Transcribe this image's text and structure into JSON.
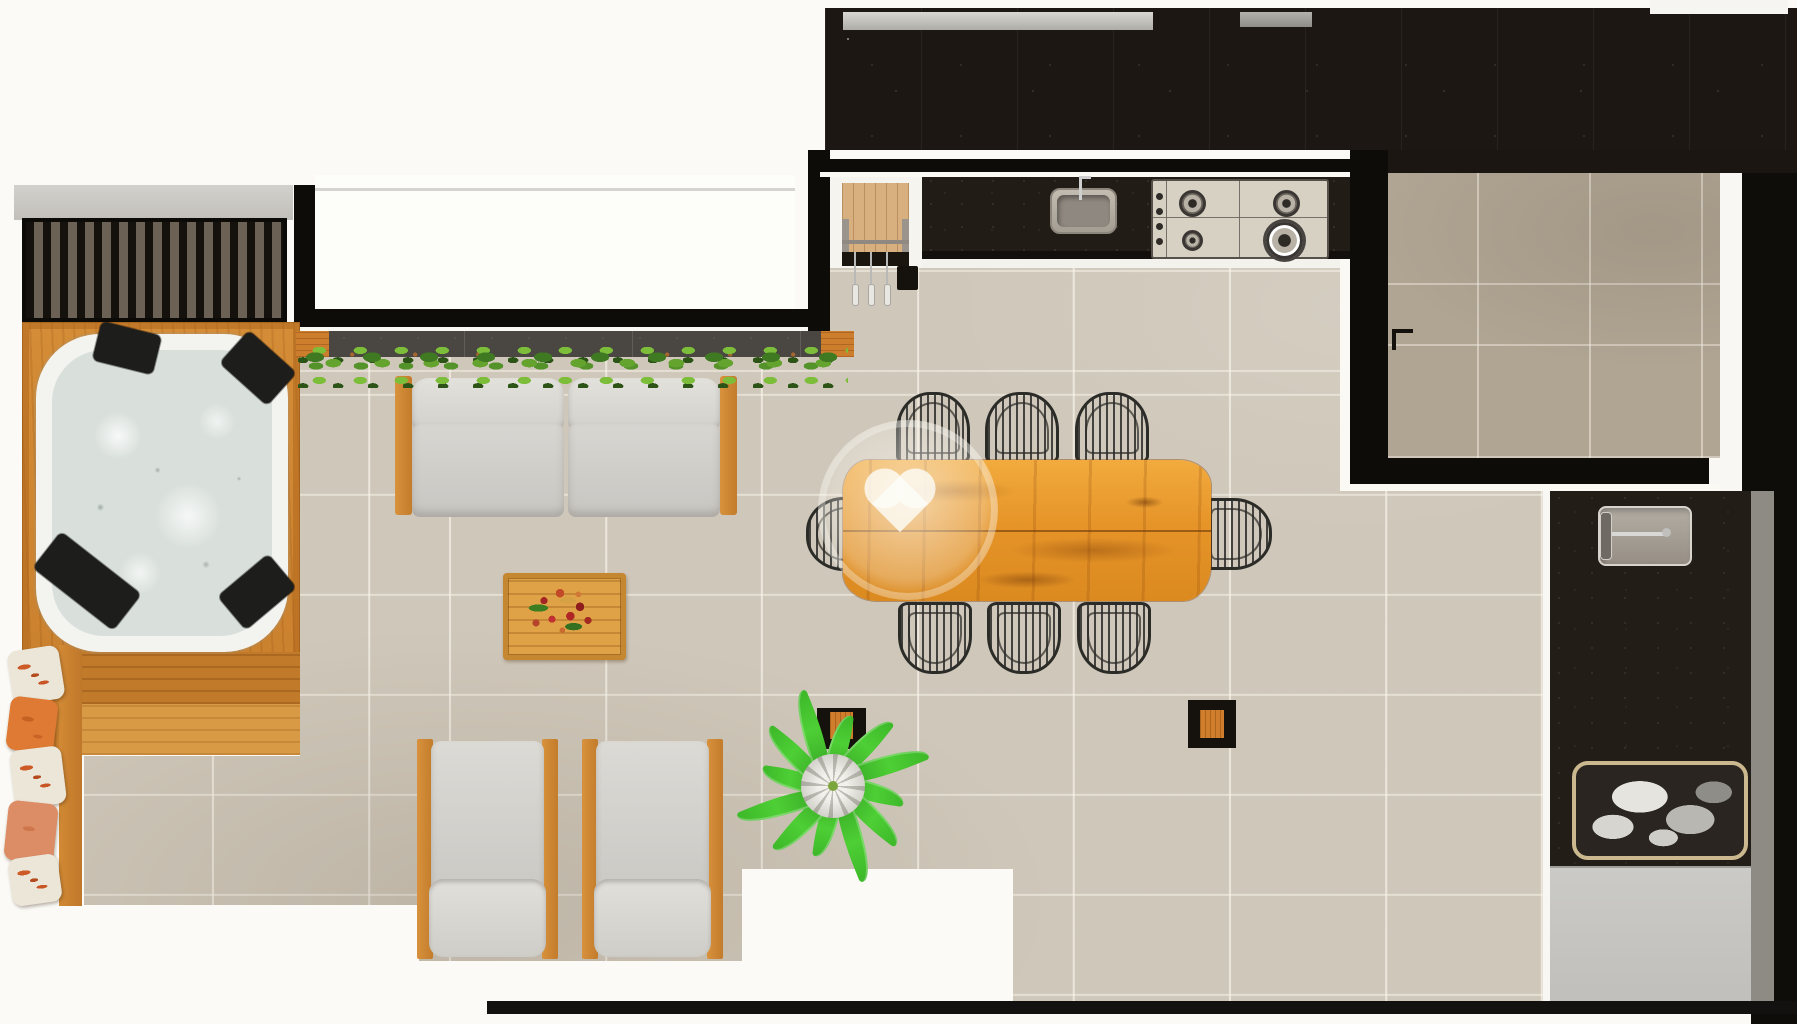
{
  "scene": {
    "kind": "architectural-floor-plan-render",
    "view": "top-down",
    "canvas": {
      "width_px": 1797,
      "height_px": 1024
    },
    "visible_text": "none",
    "watermark": {
      "shape": "heart-in-circle",
      "color": "rgba(250,248,243,0.6)",
      "area": "over dining table left edge"
    }
  },
  "palette": {
    "background_white": "#fbfaf6",
    "terrace_floor": "#cfc7b9",
    "service_room_floor": "#b0a493",
    "roof_mass_black": "#1c1712",
    "wall_black": "#0e0c09",
    "counter_granite": "#211c16",
    "teak_wood": "#d48c36",
    "dining_table_wood": "#e69428",
    "coffee_table_wood": "#e0a246",
    "cabinet_wood": "#d8af7e",
    "cushion_gray": "#d6d4cf",
    "water": "#d9e0dc",
    "hedge_green": "#63a32e",
    "plant_green": "#4ecf35",
    "pillow_orange": "#de7a33",
    "wicker_black": "#2b2b28",
    "gray_mat": "#c6c5c1",
    "stainless": "#d7d1c3"
  },
  "areas": {
    "spa_corner": {
      "label": "Spa deck with hot tub",
      "hot_tub": {
        "headrest_pads": 4,
        "water_state": "bubbling foam"
      },
      "slat_screen": {
        "style": "black louvered slats"
      },
      "lounge_pillows": {
        "count": 5,
        "styles": [
          "white floral",
          "orange",
          "white floral",
          "salmon",
          "white floral"
        ]
      }
    },
    "living_zone": {
      "label": "Outdoor living zone",
      "sofa": {
        "seats": 2,
        "frame": "teak",
        "cushions": "light gray"
      },
      "hedge_planter": {
        "type": "boxwood hedge in dark planter",
        "wood_end_caps": 2
      },
      "coffee_table": {
        "decor": "red flower bouquet"
      },
      "armchairs": {
        "count": 2,
        "frame": "teak",
        "cushions": "light gray"
      },
      "floor_plant": {
        "type": "rosette palm",
        "leaves": 12
      },
      "square_planters": {
        "count": 2
      }
    },
    "dining_zone": {
      "label": "Dining zone",
      "table": {
        "type": "live-edge wood slab",
        "seats": 8
      },
      "chairs": {
        "count": 8,
        "style": "black rattan barrel",
        "arrangement": "3 top, 3 bottom, 1 left, 1 right"
      }
    },
    "kitchen": {
      "label": "Gourmet kitchen",
      "counter": "black granite",
      "sink": {
        "faucet": 1
      },
      "cooktop": {
        "burners": 4,
        "knobs": 4
      },
      "cabinet": {
        "material": "light wood planks"
      },
      "hanging_utensils": {
        "count": 3
      },
      "waste_bin": 1
    },
    "service_room": {
      "label": "Service / BBQ room",
      "floor": "dark taupe tile",
      "door_handle": 1
    },
    "outdoor_counter": {
      "label": "Right-side outdoor counter",
      "prep_sink": {
        "faucet_arm": "horizontal"
      },
      "towel_basket": {
        "contents": "folded towels"
      },
      "gray_mat": 1
    }
  }
}
